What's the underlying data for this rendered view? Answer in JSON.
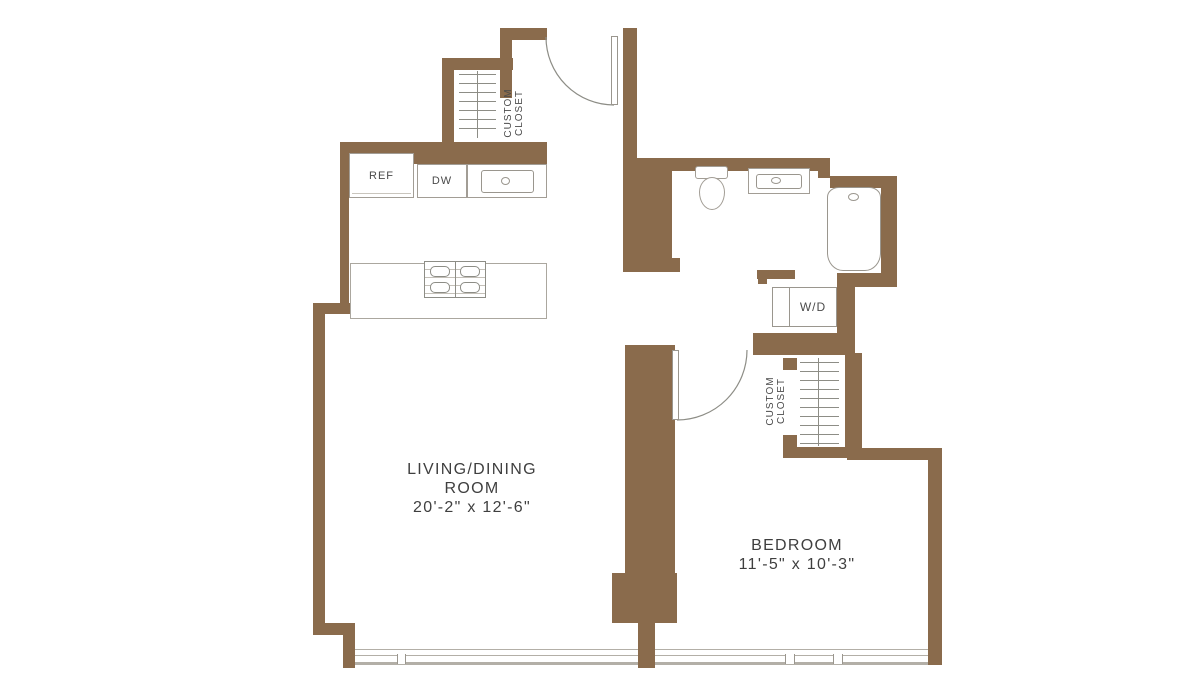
{
  "plan": {
    "type": "apartment floor plan",
    "colors": {
      "wall": "#8a6b4c",
      "fixture_line": "#a29d95",
      "text": "#3f3f3f",
      "window_line": "#b3afa7"
    }
  },
  "rooms": {
    "living_dining": {
      "line1": "LIVING/DINING",
      "line2": "ROOM",
      "dimensions": "20'-2\" x 12'-6\""
    },
    "bedroom": {
      "name": "BEDROOM",
      "dimensions": "11'-5\" x 10'-3\""
    }
  },
  "labels": {
    "refrigerator": "REF",
    "dishwasher": "DW",
    "washer_dryer": "W/D",
    "closet_line1": "CUSTOM",
    "closet_line2": "CLOSET"
  }
}
